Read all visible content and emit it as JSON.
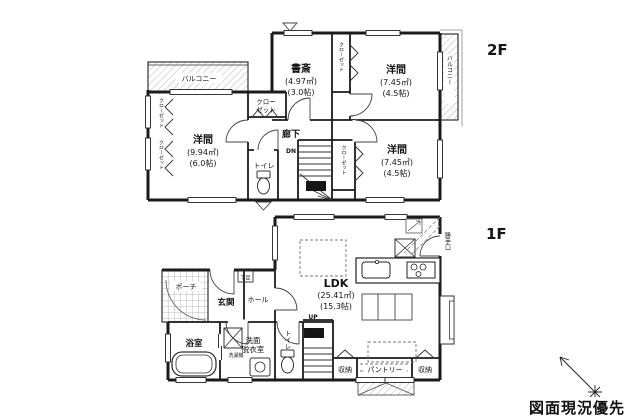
{
  "colors": {
    "line": "#1b1b1b",
    "bg": "#ffffff",
    "hatch": "#b5b5b5"
  },
  "footer": {
    "note": "図面現況優先"
  },
  "floor2": {
    "floor_label": "2F",
    "rooms": {
      "study": {
        "name": "書斎",
        "area": "(4.97㎡)",
        "tatami": "(3.0帖)"
      },
      "western_ne": {
        "name": "洋間",
        "area": "(7.45㎡)",
        "tatami": "(4.5帖)"
      },
      "western_w": {
        "name": "洋間",
        "area": "(9.94㎡)",
        "tatami": "(6.0帖)"
      },
      "western_se": {
        "name": "洋間",
        "area": "(7.45㎡)",
        "tatami": "(4.5帖)"
      },
      "hallway": "廊下",
      "toilet": "トイレ"
    },
    "labels": {
      "balcony_top": "バルコニー",
      "balcony_right": "バルコニー",
      "closet_left_upper": "クローゼット",
      "closet_left_lower": "クローゼット",
      "closet_center_line1": "クロー",
      "closet_center_line2": "ゼット",
      "closet_mid": "クローゼット",
      "closet_se": "クローゼット",
      "stairs_down": "DN",
      "storage": "物入"
    }
  },
  "floor1": {
    "floor_label": "1F",
    "rooms": {
      "ldk": {
        "name": "LDK",
        "area": "(25.41㎡)",
        "tatami": "(15.3帖)"
      },
      "entrance": "玄関",
      "porch": "ポーチ",
      "hall": "ホール",
      "bath": "浴室",
      "washroom_line1": "洗面",
      "washroom_line2": "脱衣室",
      "toilet": "トイレ"
    },
    "labels": {
      "storage_left": "収納",
      "pantry": "パントリー",
      "storage_right": "収納",
      "understairs": "物入",
      "stairs_up": "UP",
      "washer": "洗濯機",
      "kitchen_door": "勝手口",
      "shoe_cabinet": "下足"
    }
  }
}
